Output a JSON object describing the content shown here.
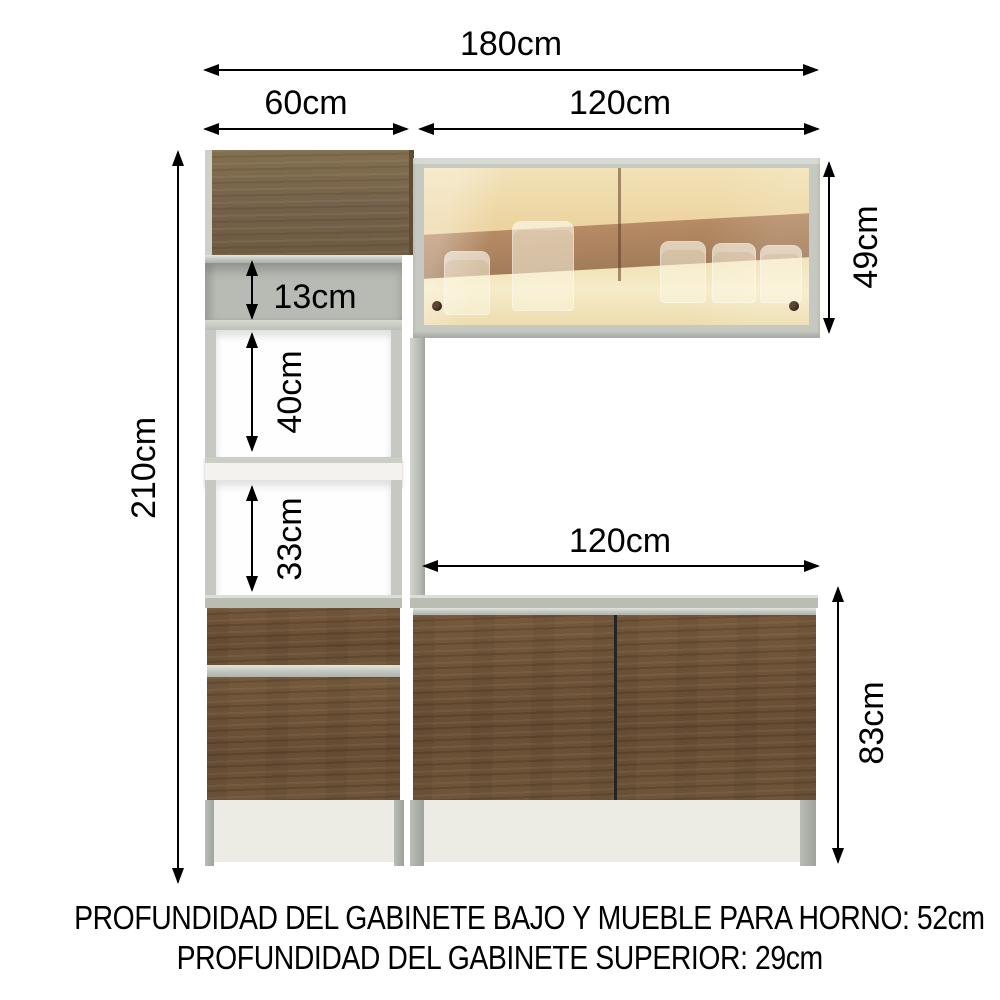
{
  "diagram_title": "kitchen cabinet set dimension diagram",
  "dims": {
    "total_width": "180cm",
    "tower_width": "60cm",
    "upper_cabinet_width": "120cm",
    "upper_cabinet_height": "49cm",
    "niche_top_height": "13cm",
    "niche_middle_height": "40cm",
    "niche_bottom_height": "33cm",
    "total_height": "210cm",
    "counter_width": "120cm",
    "base_cabinet_height": "83cm"
  },
  "footer": {
    "line1": "PROFUNDIDAD DEL GABINETE BAJO Y MUEBLE PARA HORNO: 52cm",
    "line2": "PROFUNDIDAD DEL GABINETE SUPERIOR: 29cm"
  },
  "colors": {
    "wood_door": "#7c6a4e",
    "wood_base": "#6d5339",
    "frame_gray": "#c6c9c2",
    "counter_gray": "#b9bdb4",
    "plinth": "#ecebe4",
    "glass_amber": "#eed9a8",
    "glass_band": "#a37350",
    "dim_color": "#000000"
  }
}
